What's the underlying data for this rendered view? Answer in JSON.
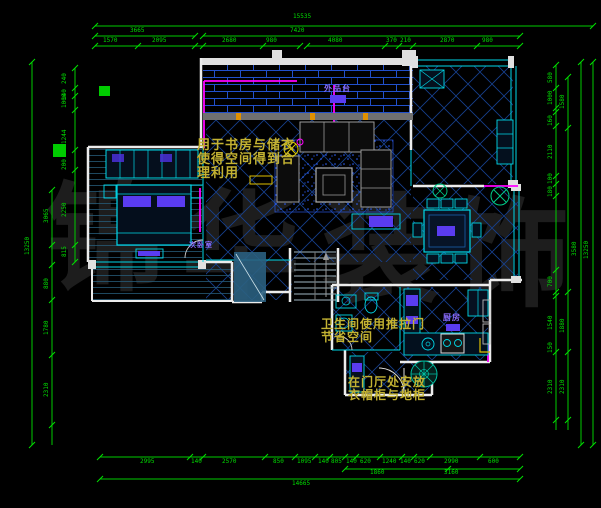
{
  "title": "residential floor plan",
  "watermark": {
    "chars": [
      "锦",
      "华",
      "装",
      "饰"
    ]
  },
  "notes": {
    "note1": [
      "用于书房与储衣",
      "使得空间得到合",
      "理利用"
    ],
    "note2": [
      "卫生间使用推拉门",
      "节省空间"
    ],
    "note3": [
      "在门厅处安放",
      "衣帽柜与地柜"
    ]
  },
  "rooms": {
    "terrace": "外品台",
    "bedroom": "次卧室",
    "kitchen": "厨房"
  },
  "dims": {
    "top_overall": "15535",
    "top_row2": [
      "3665",
      "7420"
    ],
    "top_row3": [
      "1570",
      "2095",
      "2680",
      "980",
      "4080",
      "370",
      "210",
      "2870",
      "980"
    ],
    "bottom_row1": [
      "2995",
      "140",
      "2570",
      "850",
      "1095",
      "140",
      "805",
      "140",
      "620",
      "1240",
      "140",
      "620",
      "2990",
      "600"
    ],
    "bottom_row2": [
      "1860",
      "3160"
    ],
    "bottom_overall": "14665",
    "left_col": [
      "240",
      "140",
      "1000",
      "1244",
      "200",
      "2250",
      "815"
    ],
    "left_mid": [
      "3065",
      "880",
      "1780",
      "2310"
    ],
    "left_overall": "13250",
    "right_col": [
      "580",
      "1000",
      "160",
      "2110",
      "100",
      "180",
      "700",
      "1540",
      "150",
      "2310"
    ],
    "right_mid": [
      "1580",
      "1880",
      "2310"
    ],
    "right_outer": [
      "3580",
      "13250"
    ]
  },
  "colors": {
    "background": "#000000",
    "dimension_green": "#00dd00",
    "wall_white": "#efefef",
    "tile_blue": "#1a49c0",
    "cyan": "#00d8e8",
    "magenta": "#ff00ff",
    "furniture_purple": "#5a3cf0",
    "annotation_yellow": "#c3b232",
    "label_purple": "#8a6cff",
    "watermark_gray": "#1e1e1e"
  }
}
